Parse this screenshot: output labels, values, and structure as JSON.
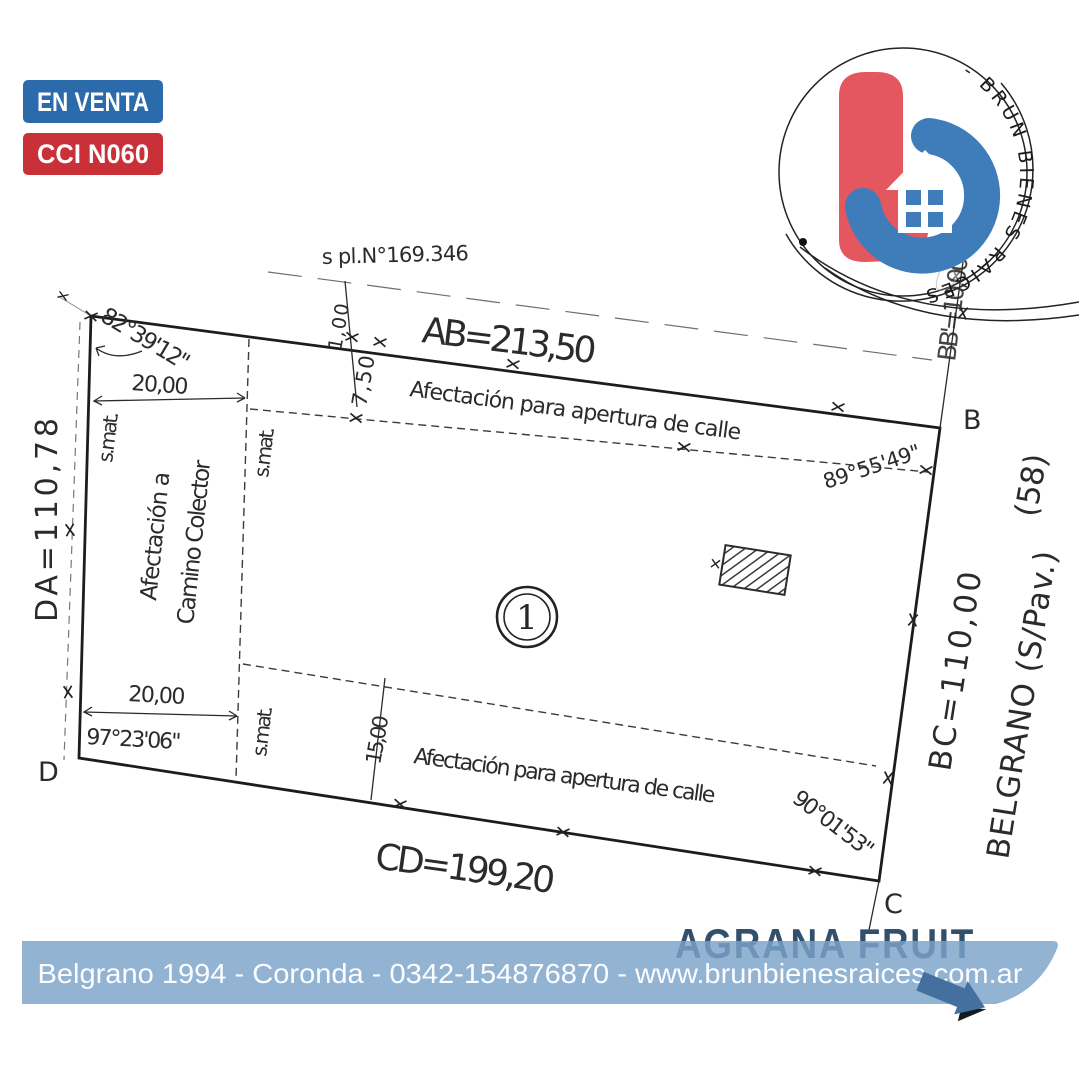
{
  "badges": {
    "status": "EN VENTA",
    "code": "CCI N060"
  },
  "logo": {
    "arc_text": "- BRUN BIENES RAICES"
  },
  "plan": {
    "reference": "s pl.N°169.346",
    "sides": {
      "ab": "AB=213,50",
      "bc": "BC=110,00",
      "cd": "CD=199,20",
      "da": "DA=110,78",
      "bb": "BB'=10,00"
    },
    "angles": {
      "a": "82°39'12\"",
      "b": "89°55'49\"",
      "c": "90°01'53\"",
      "d": "97°23'06\""
    },
    "dims": {
      "top_20": "20,00",
      "bottom_20": "20,00",
      "d_7_50": "7,50",
      "d_1_00": "1,00",
      "d_15_00": "15,00"
    },
    "smat": [
      "s.mat.",
      "s.mat.",
      "s.mat."
    ],
    "affectation_top": "Afectación para apertura de calle",
    "affectation_bottom": "Afectación para apertura de calle",
    "affectation_left_line1": "Afectación a",
    "affectation_left_line2": "Camino Colector",
    "street": "BELGRANO (S/Pav.)",
    "street_number": "(58)",
    "lot_number": "1",
    "corners": {
      "b": "B",
      "c": "C",
      "d": "D"
    }
  },
  "watermark": "AGRANA FRUIT",
  "footer": {
    "line": "Belgrano 1994 - Coronda - 0342-154876870 - www.brunbienesraices.com.ar"
  },
  "colors": {
    "badge_blue": "#2b6aab",
    "badge_red": "#c93038",
    "bar_blue": "#7ba2c9",
    "arrow_blue": "#44709f",
    "logo_red": "#e4575e",
    "logo_blue": "#3e7cba",
    "watermark_blue": "#31506e",
    "ink": "#222222"
  }
}
